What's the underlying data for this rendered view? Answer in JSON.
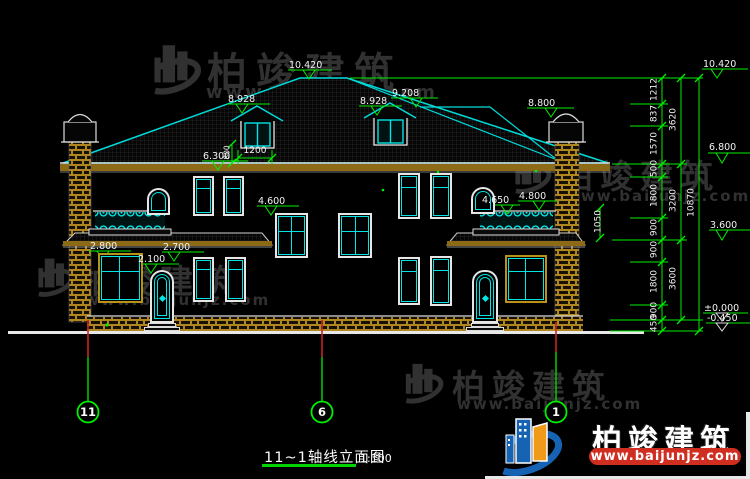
{
  "title": {
    "text": "11~1轴线立面图",
    "scale": "1:100"
  },
  "brand": {
    "name": "柏竣建筑",
    "url": "www.baijunjz.com"
  },
  "axes": {
    "a11": "11",
    "a6": "6",
    "a1": "1"
  },
  "elevations": {
    "ridge": "10.420",
    "dormer_left": "8.928",
    "dormer_right": "8.928",
    "upper_ridge": "9.208",
    "right_hip": "8.800",
    "eave": "6.300",
    "stair_window": "4.600",
    "right_balcony_low": "4.650",
    "right_balcony": "4.800",
    "left_porch": "2.800",
    "left_porch_beam": "2.700",
    "left_door": "2.100",
    "r_ridge": "10.420",
    "r_eave": "6.800",
    "r_mid": "3.600",
    "r_zero": "±0.000",
    "r_ground": "-0.450"
  },
  "dimensions": {
    "chain": [
      "1212",
      "837",
      "1570",
      "500",
      "1800",
      "900",
      "900",
      "1800",
      "900",
      "450"
    ],
    "subtotals": [
      "3620",
      "3200",
      "3600"
    ],
    "total": "10870",
    "dormer_width": "1200",
    "dormer_height": "800",
    "railing_height": "1050"
  }
}
